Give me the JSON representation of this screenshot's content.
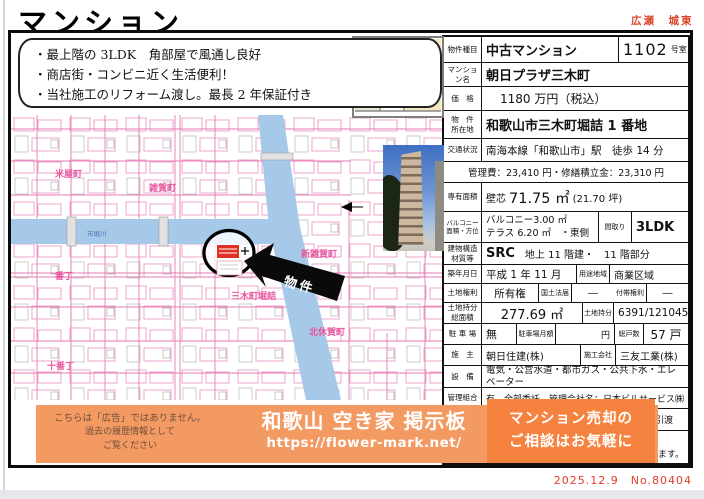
{
  "page": {
    "title": "マンション",
    "districts": "広瀬　城東",
    "date_no": "2025.12.9　No.80404"
  },
  "highlights": {
    "line1": "・最上階の 3LDK　角部屋で風通し良好",
    "line2": "・商店街・コンビニ近く生活便利！",
    "line3": "・当社施工のリフォーム渡し。最長 2 年保証付き"
  },
  "map": {
    "river_label": "市堀川",
    "komeya": "米屋町",
    "saika": "雑賀町",
    "shinsaika": "新雑賀町",
    "mikicho": "三木町堀詰",
    "kitakyuka": "北休賀町",
    "bancho": "番丁",
    "jubancho": "十番丁",
    "marker_label": "物件"
  },
  "table": {
    "r1_label": "物件種目",
    "r1_value": "中古マンション",
    "r1_room": "1102",
    "r1_room_unit": "号室",
    "r2_label": "マンション名",
    "r2_value": "朝日プラザ三木町",
    "r3_label": "価　格",
    "r3_value": "1180 万円（税込）",
    "r4_label1": "物　件",
    "r4_label2": "所在地",
    "r4_value": "和歌山市三木町堀詰 1 番地",
    "r5_label": "交通状況",
    "r5_value": "南海本線「和歌山市」駅　徒歩 14 分",
    "r6_value": "管理費：23,410 円・修繕積立金：23,310 円",
    "r7_label": "専有面積",
    "r7_prefix": "壁芯",
    "r7_area": "71.75 ㎡",
    "r7_tsubo": "(21.70 坪)",
    "r8_label1": "バルコニー",
    "r8_label2": "面積・方位",
    "r8_value1": "バルコニー3.00 ㎡",
    "r8_value2": "テラス 6.20 ㎡　・東側",
    "r8_label3": "間取り",
    "r8_madori": "3LDK",
    "r9_label1": "建物構造",
    "r9_label2": "材質等",
    "r9_value1": "SRC",
    "r9_value2": "地上 11 階建・　11 階部分",
    "r10_label": "築年月日",
    "r10_value": "平成 1 年 11 月",
    "r10_label2": "用途地域",
    "r10_value2": "商業区域",
    "r11_label": "土地権利",
    "r11_value": "所有権",
    "r11_label2": "国土法届",
    "r11_value2": "―",
    "r11_label3": "付帯権利",
    "r11_value3": "―",
    "r12_label1": "土地持分",
    "r12_label2": "総面積",
    "r12_value": "277.69 ㎡",
    "r12_label3": "土地持分",
    "r12_value2": "6391/121045",
    "r13_label": "駐 車 場",
    "r13_value": "無",
    "r13_label2": "駐車場月額",
    "r13_unit": "円",
    "r13_label3": "総戸数",
    "r13_value2": "57 戸",
    "r14_label": "施　主",
    "r14_value": "朝日住建(株)",
    "r14_label2": "施工会社",
    "r14_value2": "三友工業(株)",
    "r15_label": "設　備",
    "r15_value": "電気・公営水道・都市ガス・公共下水・エレベーター",
    "r16_label": "管理組合",
    "r16_value": "有　全部委託　管理会社名：日本ビルサービス㈱",
    "r17_partial": "引渡",
    "r18_partial": "きます。"
  },
  "banner": {
    "disclaimer1": "こちらは「広告」ではありません。",
    "disclaimer2": "過去の履歴情報として",
    "disclaimer3": "ご覧ください",
    "title": "和歌山 空き家 掲示板",
    "url": "https://flower-mark.net/",
    "promo1": "マンション売却の",
    "promo2": "ご相談はお気軽に"
  }
}
